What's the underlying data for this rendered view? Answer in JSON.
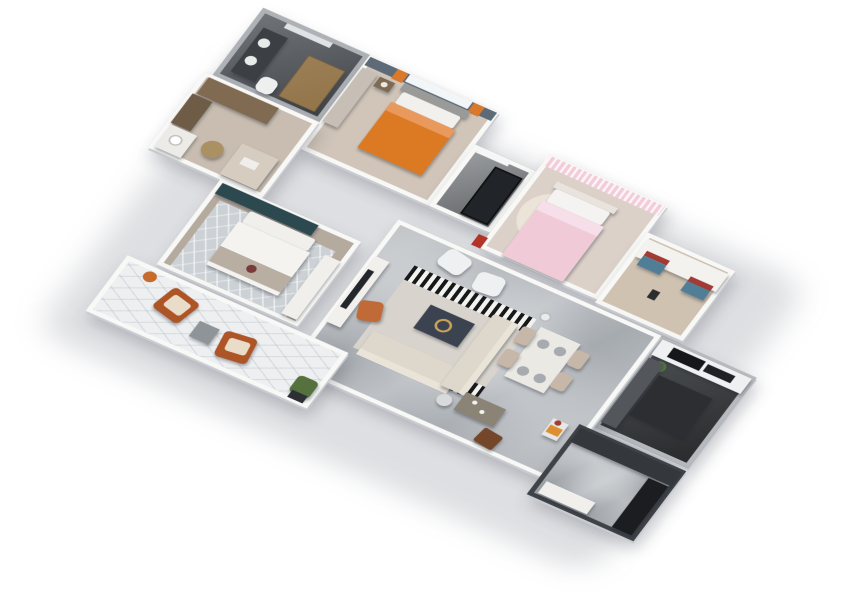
{
  "scene": {
    "background": "#ffffff",
    "plan_width": 780,
    "plan_height": 560,
    "rotation_deg": 30,
    "tilt_deg": 40,
    "scale": 0.88,
    "palette": {
      "wall": "#f8f8f6",
      "wall_edge": "#c9ccd1",
      "marble_floor": "#a6abb0",
      "wood_floor": "#d0c5b8",
      "dark_floor": "#3a3d40",
      "accent_orange": "#dc7a24",
      "accent_pink": "#f0cbd7",
      "accent_teal": "#2d4950",
      "accent_rust": "#ae5527",
      "accent_blue": "#4f7e96",
      "accent_red": "#a23b35",
      "gold": "#c9a35a"
    }
  },
  "rooms": [
    {
      "id": "bathroom",
      "x": 20,
      "y": 0,
      "w": 140,
      "h": 115,
      "floor": "#5f6368",
      "wall": "#aeb2b7",
      "texture": "darkfloor"
    },
    {
      "id": "bedroom-2",
      "x": 160,
      "y": 0,
      "w": 170,
      "h": 160,
      "floor": "#d0c5b8",
      "wall": "#f8f8f6",
      "texture": ""
    },
    {
      "id": "storage",
      "x": 330,
      "y": 55,
      "w": 80,
      "h": 105,
      "floor": "#8d9093",
      "wall": "#f8f8f6",
      "texture": "darkfloor"
    },
    {
      "id": "bedroom-3",
      "x": 410,
      "y": 25,
      "w": 155,
      "h": 160,
      "floor": "#dbd1c8",
      "wall": "#f8f8f6",
      "texture": ""
    },
    {
      "id": "study",
      "x": 565,
      "y": 70,
      "w": 115,
      "h": 120,
      "floor": "#cfc2b1",
      "wall": "#f8f8f6",
      "texture": ""
    },
    {
      "id": "kitchen",
      "x": 655,
      "y": 195,
      "w": 125,
      "h": 155,
      "floor": "#3a3d40",
      "wall": "#b6b9bd",
      "texture": "darkfloor"
    },
    {
      "id": "dressing-room",
      "x": 10,
      "y": 115,
      "w": 150,
      "h": 130,
      "floor": "#c8bdb0",
      "wall": "#f8f8f6",
      "texture": ""
    },
    {
      "id": "master-bedroom",
      "x": 105,
      "y": 245,
      "w": 185,
      "h": 145,
      "floor": "#b5aa9e",
      "wall": "#f8f8f6",
      "texture": ""
    },
    {
      "id": "living-dining",
      "x": 310,
      "y": 195,
      "w": 345,
      "h": 250,
      "floor": "#a6abb0",
      "wall": "#f8f8f6",
      "texture": "marble"
    },
    {
      "id": "entry-hall",
      "x": 640,
      "y": 355,
      "w": 140,
      "h": 120,
      "floor": "#9ba0a5",
      "wall": "#3f4348",
      "texture": "marble"
    },
    {
      "id": "balcony",
      "x": 70,
      "y": 395,
      "w": 290,
      "h": 95,
      "floor": "#edeff1",
      "wall": "#f8f8f6",
      "texture": "hex"
    }
  ],
  "furniture": [
    {
      "name": "bathroom-mirror-strip",
      "shape": "rect",
      "x": 55,
      "y": 6,
      "w": 60,
      "h": 8,
      "color": "#dfe3e6"
    },
    {
      "name": "bathroom-vanity",
      "shape": "rect",
      "x": 35,
      "y": 25,
      "w": 32,
      "h": 75,
      "color": "#3c4044",
      "raised": true
    },
    {
      "name": "bathroom-sink-1",
      "shape": "circle",
      "x": 40,
      "y": 38,
      "w": 14,
      "h": 14,
      "color": "#e9ebeb"
    },
    {
      "name": "bathroom-sink-2",
      "shape": "circle",
      "x": 40,
      "y": 68,
      "w": 14,
      "h": 14,
      "color": "#e9ebeb"
    },
    {
      "name": "bathroom-shower-glass",
      "shape": "rect",
      "x": 100,
      "y": 35,
      "w": 48,
      "h": 70,
      "color": "#d29a4a",
      "opacity": 0.55,
      "border": "1px solid #8a6228",
      "raised": true
    },
    {
      "name": "bathroom-toilet",
      "shape": "rect",
      "x": 70,
      "y": 86,
      "w": 22,
      "h": 24,
      "color": "#eef0f0",
      "radius": 8,
      "raised": true
    },
    {
      "name": "bedroom2-accent-wall",
      "shape": "rect",
      "x": 162,
      "y": 2,
      "w": 166,
      "h": 14,
      "color": "#5d6b78"
    },
    {
      "name": "bedroom2-window",
      "shape": "rect",
      "x": 214,
      "y": 2,
      "w": 82,
      "h": 12,
      "color": "#f3f6f8"
    },
    {
      "name": "bedroom2-curtain-left",
      "shape": "rect",
      "x": 198,
      "y": 2,
      "w": 14,
      "h": 16,
      "color": "#d8792b"
    },
    {
      "name": "bedroom2-curtain-right",
      "shape": "rect",
      "x": 298,
      "y": 2,
      "w": 14,
      "h": 16,
      "color": "#d8792b"
    },
    {
      "name": "bedroom2-wardrobe",
      "shape": "rect",
      "x": 162,
      "y": 20,
      "w": 20,
      "h": 92,
      "color": "#c7bfb5",
      "raised": true
    },
    {
      "name": "bedroom2-nightstand",
      "shape": "rect",
      "x": 186,
      "y": 22,
      "w": 20,
      "h": 16,
      "color": "#7d6b55",
      "raised": true
    },
    {
      "name": "bedroom2-lamp",
      "shape": "circle",
      "x": 192,
      "y": 26,
      "w": 8,
      "h": 8,
      "color": "#efe9dc"
    },
    {
      "name": "bedroom2-headboard",
      "shape": "rect",
      "x": 215,
      "y": 16,
      "w": 86,
      "h": 12,
      "color": "#9a9a98",
      "raised": true
    },
    {
      "name": "bedroom2-pillows",
      "shape": "rect",
      "x": 220,
      "y": 28,
      "w": 76,
      "h": 20,
      "color": "#f1f0ed",
      "radius": 3,
      "raised": true
    },
    {
      "name": "bedroom2-duvet-orange",
      "shape": "rect",
      "x": 216,
      "y": 48,
      "w": 84,
      "h": 78,
      "color": "#dc7a24",
      "radius": 2,
      "raised": true
    },
    {
      "name": "bedroom2-duvet-fold",
      "shape": "rect",
      "x": 216,
      "y": 48,
      "w": 84,
      "h": 14,
      "color": "#e9995c"
    },
    {
      "name": "storage-window",
      "shape": "rect",
      "x": 336,
      "y": 57,
      "w": 42,
      "h": 8,
      "color": "#f4f6f7"
    },
    {
      "name": "storage-metal-shelf",
      "shape": "rect",
      "x": 366,
      "y": 72,
      "w": 36,
      "h": 80,
      "color": "#212428",
      "border": "2px solid #0e0f10",
      "raised": true
    },
    {
      "name": "hallway-red-art",
      "shape": "rect",
      "x": 400,
      "y": 168,
      "w": 12,
      "h": 18,
      "color": "#b23327"
    },
    {
      "name": "bedroom3-curtains",
      "shape": "rect",
      "x": 412,
      "y": 27,
      "w": 151,
      "h": 16,
      "color": "#f2cdd9",
      "texture": "sheer"
    },
    {
      "name": "bedroom3-round-rug",
      "shape": "circle",
      "x": 422,
      "y": 70,
      "w": 80,
      "h": 80,
      "color": "#ece4d8"
    },
    {
      "name": "bedroom3-headboard",
      "shape": "rect",
      "x": 438,
      "y": 56,
      "w": 80,
      "h": 10,
      "color": "#e9e3dd",
      "raised": true
    },
    {
      "name": "bedroom3-pillows",
      "shape": "rect",
      "x": 442,
      "y": 66,
      "w": 72,
      "h": 22,
      "color": "#f5f3f1",
      "radius": 3,
      "raised": true
    },
    {
      "name": "bedroom3-duvet-pink",
      "shape": "rect",
      "x": 438,
      "y": 88,
      "w": 80,
      "h": 94,
      "color": "#f0cbd7",
      "radius": 2,
      "raised": true
    },
    {
      "name": "bedroom3-duvet-fold",
      "shape": "rect",
      "x": 438,
      "y": 88,
      "w": 80,
      "h": 16,
      "color": "#f6dfe8"
    },
    {
      "name": "study-desk",
      "shape": "rect",
      "x": 570,
      "y": 78,
      "w": 106,
      "h": 30,
      "color": "#f3f2ef",
      "raised": true
    },
    {
      "name": "study-cushion1-red",
      "shape": "rect",
      "x": 578,
      "y": 94,
      "w": 30,
      "h": 8,
      "color": "#a23b35"
    },
    {
      "name": "study-cushion1-blue",
      "shape": "rect",
      "x": 578,
      "y": 102,
      "w": 30,
      "h": 16,
      "color": "#4f7e96",
      "raised": true
    },
    {
      "name": "study-cushion2-red",
      "shape": "rect",
      "x": 640,
      "y": 102,
      "w": 30,
      "h": 8,
      "color": "#a23b35"
    },
    {
      "name": "study-cushion2-blue",
      "shape": "rect",
      "x": 640,
      "y": 110,
      "w": 30,
      "h": 16,
      "color": "#4f7e96",
      "raised": true
    },
    {
      "name": "study-phone",
      "shape": "rect",
      "x": 612,
      "y": 140,
      "w": 10,
      "h": 14,
      "color": "#2b2d30"
    },
    {
      "name": "kitchen-counter-white",
      "shape": "rect",
      "x": 659,
      "y": 199,
      "w": 117,
      "h": 26,
      "color": "#eef0f1",
      "raised": true
    },
    {
      "name": "kitchen-cooktop",
      "shape": "rect",
      "x": 676,
      "y": 203,
      "w": 42,
      "h": 16,
      "color": "#15171a"
    },
    {
      "name": "kitchen-hood",
      "shape": "rect",
      "x": 722,
      "y": 205,
      "w": 36,
      "h": 12,
      "color": "#1f2124"
    },
    {
      "name": "kitchen-plant",
      "shape": "circle",
      "x": 668,
      "y": 228,
      "w": 16,
      "h": 16,
      "color": "#4e7c3d"
    },
    {
      "name": "kitchen-side-counter",
      "shape": "rect",
      "x": 659,
      "y": 230,
      "w": 20,
      "h": 110,
      "color": "#53575c",
      "raised": true
    },
    {
      "name": "kitchen-island-dark",
      "shape": "rect",
      "x": 682,
      "y": 247,
      "w": 70,
      "h": 68,
      "color": "#2c2e31",
      "raised": true
    },
    {
      "name": "dressing-wardrobe",
      "shape": "rect",
      "x": 18,
      "y": 120,
      "w": 92,
      "h": 28,
      "color": "#806b52",
      "raised": true
    },
    {
      "name": "dressing-cabinet",
      "shape": "rect",
      "x": 14,
      "y": 150,
      "w": 26,
      "h": 50,
      "color": "#6e5c47",
      "raised": true
    },
    {
      "name": "dressing-vanity",
      "shape": "rect",
      "x": 16,
      "y": 202,
      "w": 34,
      "h": 38,
      "color": "#ecebe7",
      "raised": true
    },
    {
      "name": "dressing-sink",
      "shape": "circle",
      "x": 24,
      "y": 212,
      "w": 16,
      "h": 16,
      "color": "#ffffff",
      "border": "2px solid #c0c0bd"
    },
    {
      "name": "dressing-basket",
      "shape": "circle",
      "x": 62,
      "y": 198,
      "w": 26,
      "h": 26,
      "color": "#ab9064",
      "raised": true
    },
    {
      "name": "dressing-bench",
      "shape": "rect",
      "x": 100,
      "y": 186,
      "w": 48,
      "h": 52,
      "color": "#d6ccc0",
      "raised": true
    },
    {
      "name": "dressing-tray",
      "shape": "rect",
      "x": 112,
      "y": 202,
      "w": 20,
      "h": 12,
      "color": "#efeeea"
    },
    {
      "name": "master-headboard-wall-teal",
      "shape": "rect",
      "x": 110,
      "y": 248,
      "w": 126,
      "h": 18,
      "color": "#2d4950",
      "raised": true
    },
    {
      "name": "master-rug",
      "shape": "rect",
      "x": 120,
      "y": 272,
      "w": 152,
      "h": 112,
      "color": "#ccd1d5",
      "texture": "diag"
    },
    {
      "name": "master-pillows",
      "shape": "rect",
      "x": 158,
      "y": 268,
      "w": 86,
      "h": 20,
      "color": "#f0efec",
      "radius": 3,
      "raised": true
    },
    {
      "name": "master-duvet",
      "shape": "rect",
      "x": 154,
      "y": 288,
      "w": 94,
      "h": 74,
      "color": "#f4f3f0",
      "radius": 2,
      "raised": true
    },
    {
      "name": "master-throw",
      "shape": "rect",
      "x": 154,
      "y": 330,
      "w": 94,
      "h": 26,
      "color": "#b9aea2"
    },
    {
      "name": "master-cushion",
      "shape": "circle",
      "x": 196,
      "y": 336,
      "w": 12,
      "h": 12,
      "color": "#7a3b3a"
    },
    {
      "name": "master-tv-console",
      "shape": "rect",
      "x": 264,
      "y": 282,
      "w": 20,
      "h": 100,
      "color": "#f1efeb",
      "raised": true
    },
    {
      "name": "living-tv-console",
      "shape": "rect",
      "x": 315,
      "y": 255,
      "w": 18,
      "h": 112,
      "color": "#f2f0ec",
      "raised": true
    },
    {
      "name": "living-tv",
      "shape": "rect",
      "x": 317,
      "y": 276,
      "w": 8,
      "h": 64,
      "color": "#23262a"
    },
    {
      "name": "living-rug",
      "shape": "rect",
      "x": 360,
      "y": 245,
      "w": 160,
      "h": 140,
      "color": "#d8d4cd"
    },
    {
      "name": "living-rug-stripes-top",
      "shape": "rect",
      "x": 360,
      "y": 245,
      "w": 160,
      "h": 24,
      "color": "",
      "texture": "stripes"
    },
    {
      "name": "living-rug-stripes-bottom",
      "shape": "rect",
      "x": 426,
      "y": 361,
      "w": 94,
      "h": 24,
      "color": "",
      "texture": "stripes"
    },
    {
      "name": "living-armchair-1",
      "shape": "rect",
      "x": 380,
      "y": 203,
      "w": 34,
      "h": 30,
      "color": "#eef0f1",
      "radius": 8,
      "rotate": 12,
      "raised": true
    },
    {
      "name": "living-armchair-2",
      "shape": "rect",
      "x": 430,
      "y": 212,
      "w": 34,
      "h": 30,
      "color": "#eef0f1",
      "radius": 8,
      "rotate": -6,
      "raised": true
    },
    {
      "name": "living-floor-lamp",
      "shape": "circle",
      "x": 520,
      "y": 230,
      "w": 14,
      "h": 14,
      "color": "#e8eaec",
      "border": "2px solid #b9bcc0"
    },
    {
      "name": "living-accent-chair-orange",
      "shape": "rect",
      "x": 336,
      "y": 314,
      "w": 28,
      "h": 30,
      "color": "#c06a38",
      "radius": 6,
      "rotate": -20,
      "raised": true
    },
    {
      "name": "living-coffee-table",
      "shape": "rect",
      "x": 405,
      "y": 286,
      "w": 58,
      "h": 40,
      "color": "#3c4350",
      "raised": true
    },
    {
      "name": "living-coffee-table-gold-ring",
      "shape": "circle",
      "x": 423,
      "y": 296,
      "w": 20,
      "h": 20,
      "color": "",
      "border": "3px solid #c9a35a"
    },
    {
      "name": "living-sofa-seat",
      "shape": "rect",
      "x": 368,
      "y": 352,
      "w": 118,
      "h": 34,
      "color": "#ded7cb",
      "radius": 3,
      "raised": true
    },
    {
      "name": "living-sofa-back",
      "shape": "rect",
      "x": 368,
      "y": 382,
      "w": 118,
      "h": 10,
      "color": "#e9e3d8"
    },
    {
      "name": "living-sofa-chaise",
      "shape": "rect",
      "x": 474,
      "y": 262,
      "w": 32,
      "h": 122,
      "color": "#ded7cb",
      "radius": 3,
      "raised": true
    },
    {
      "name": "living-sofa-chaise-back",
      "shape": "rect",
      "x": 498,
      "y": 262,
      "w": 8,
      "h": 122,
      "color": "#e9e3d8"
    },
    {
      "name": "living-side-table",
      "shape": "circle",
      "x": 480,
      "y": 392,
      "w": 18,
      "h": 18,
      "color": "#d8dadc",
      "raised": true
    },
    {
      "name": "dining-table",
      "shape": "rect",
      "x": 530,
      "y": 252,
      "w": 52,
      "h": 84,
      "color": "#ebe9e4",
      "raised": true
    },
    {
      "name": "dining-chair-1",
      "shape": "rect",
      "x": 512,
      "y": 260,
      "w": 18,
      "h": 26,
      "color": "#c6b7a9",
      "radius": 4,
      "raised": true
    },
    {
      "name": "dining-chair-2",
      "shape": "rect",
      "x": 512,
      "y": 298,
      "w": 18,
      "h": 26,
      "color": "#c6b7a9",
      "radius": 4,
      "raised": true
    },
    {
      "name": "dining-chair-3",
      "shape": "rect",
      "x": 582,
      "y": 260,
      "w": 18,
      "h": 26,
      "color": "#c6b7a9",
      "radius": 4,
      "raised": true
    },
    {
      "name": "dining-chair-4",
      "shape": "rect",
      "x": 582,
      "y": 298,
      "w": 18,
      "h": 26,
      "color": "#c6b7a9",
      "radius": 4,
      "raised": true
    },
    {
      "name": "dining-plate-1",
      "shape": "circle",
      "x": 538,
      "y": 266,
      "w": 14,
      "h": 14,
      "color": "#a7abaf"
    },
    {
      "name": "dining-plate-2",
      "shape": "circle",
      "x": 560,
      "y": 266,
      "w": 14,
      "h": 14,
      "color": "#a7abaf"
    },
    {
      "name": "dining-plate-3",
      "shape": "circle",
      "x": 538,
      "y": 312,
      "w": 14,
      "h": 14,
      "color": "#a7abaf"
    },
    {
      "name": "dining-plate-4",
      "shape": "circle",
      "x": 560,
      "y": 312,
      "w": 14,
      "h": 14,
      "color": "#a7abaf"
    },
    {
      "name": "hall-console-table",
      "shape": "rect",
      "x": 505,
      "y": 378,
      "w": 52,
      "h": 30,
      "color": "#8c8377",
      "raised": true
    },
    {
      "name": "hall-console-cup-1",
      "shape": "circle",
      "x": 518,
      "y": 384,
      "w": 6,
      "h": 6,
      "color": "#f2f2f0"
    },
    {
      "name": "hall-console-cup-2",
      "shape": "circle",
      "x": 532,
      "y": 392,
      "w": 6,
      "h": 6,
      "color": "#f2f2f0"
    },
    {
      "name": "hall-ottoman-brown",
      "shape": "rect",
      "x": 548,
      "y": 414,
      "w": 26,
      "h": 24,
      "color": "#74472a",
      "radius": 3,
      "rotate": 8,
      "raised": true
    },
    {
      "name": "hall-bar-cart",
      "shape": "rect",
      "x": 610,
      "y": 362,
      "w": 20,
      "h": 28,
      "color": "#e7e7e5",
      "raised": true
    },
    {
      "name": "hall-bar-cart-box",
      "shape": "rect",
      "x": 612,
      "y": 372,
      "w": 16,
      "h": 12,
      "color": "#dd8f2f"
    },
    {
      "name": "hall-bar-cart-bottle",
      "shape": "circle",
      "x": 614,
      "y": 362,
      "w": 8,
      "h": 8,
      "color": "#a23b35"
    },
    {
      "name": "entry-dark-wall-panel",
      "shape": "rect",
      "x": 644,
      "y": 359,
      "w": 132,
      "h": 24,
      "color": "#34383c",
      "raised": true
    },
    {
      "name": "entry-bench-dark",
      "shape": "rect",
      "x": 748,
      "y": 385,
      "w": 26,
      "h": 84,
      "color": "#1b1d20",
      "raised": true
    },
    {
      "name": "entry-shoe-cabinet",
      "shape": "rect",
      "x": 650,
      "y": 447,
      "w": 64,
      "h": 20,
      "color": "#f0efec",
      "raised": true
    },
    {
      "name": "balcony-armchair-1",
      "shape": "rect",
      "x": 135,
      "y": 412,
      "w": 40,
      "h": 40,
      "color": "#ae5527",
      "radius": 6,
      "rotate": 14,
      "raised": true
    },
    {
      "name": "balcony-cushion-1",
      "shape": "rect",
      "x": 143,
      "y": 420,
      "w": 26,
      "h": 22,
      "color": "#e9dcc8",
      "radius": 4,
      "rotate": 14
    },
    {
      "name": "balcony-armchair-2",
      "shape": "rect",
      "x": 225,
      "y": 432,
      "w": 40,
      "h": 40,
      "color": "#ae5527",
      "radius": 6,
      "rotate": -8,
      "raised": true
    },
    {
      "name": "balcony-cushion-2",
      "shape": "rect",
      "x": 233,
      "y": 440,
      "w": 26,
      "h": 20,
      "color": "#e9dcc8",
      "radius": 4,
      "rotate": -8
    },
    {
      "name": "balcony-cube-table",
      "shape": "rect",
      "x": 190,
      "y": 438,
      "w": 26,
      "h": 26,
      "color": "#8f9499",
      "raised": true
    },
    {
      "name": "balcony-plant",
      "shape": "rect",
      "x": 328,
      "y": 450,
      "w": 26,
      "h": 28,
      "color": "#54713e",
      "radius": 6,
      "raised": true
    },
    {
      "name": "balcony-planter",
      "shape": "rect",
      "x": 332,
      "y": 474,
      "w": 20,
      "h": 12,
      "color": "#2c2f33"
    },
    {
      "name": "balcony-orange-pot",
      "shape": "circle",
      "x": 100,
      "y": 402,
      "w": 16,
      "h": 16,
      "color": "#c76a2e"
    }
  ]
}
